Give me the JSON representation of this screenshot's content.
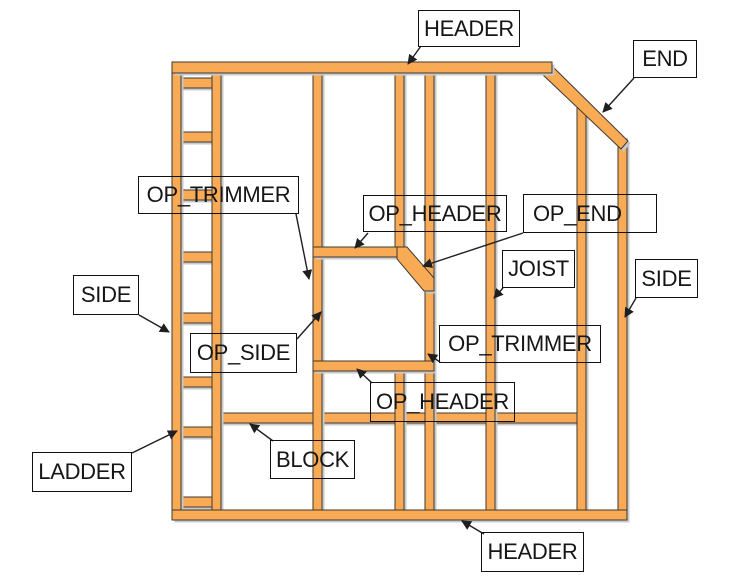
{
  "diagram": {
    "labels": [
      {
        "id": "header-top",
        "text": "HEADER"
      },
      {
        "id": "end",
        "text": "END"
      },
      {
        "id": "op-trimmer-left",
        "text": "OP_TRIMMER"
      },
      {
        "id": "op-header-top",
        "text": "OP_HEADER"
      },
      {
        "id": "op-end",
        "text": "OP_END"
      },
      {
        "id": "joist",
        "text": "JOIST"
      },
      {
        "id": "side-right",
        "text": "SIDE"
      },
      {
        "id": "side-left",
        "text": "SIDE"
      },
      {
        "id": "op-side",
        "text": "OP_SIDE"
      },
      {
        "id": "op-trimmer-right",
        "text": "OP_TRIMMER"
      },
      {
        "id": "op-header-bottom",
        "text": "OP_HEADER"
      },
      {
        "id": "block",
        "text": "BLOCK"
      },
      {
        "id": "ladder",
        "text": "LADDER"
      },
      {
        "id": "header-bottom",
        "text": "HEADER"
      }
    ],
    "colors": {
      "lumber_fill": "#F8AB54",
      "lumber_outline": "#3E3A33",
      "lumber_shadow": "#C9C9C9",
      "arrow": "#1F1F1F",
      "label_border": "#111111",
      "label_text": "#161616",
      "background": "#FFFFFF"
    }
  }
}
